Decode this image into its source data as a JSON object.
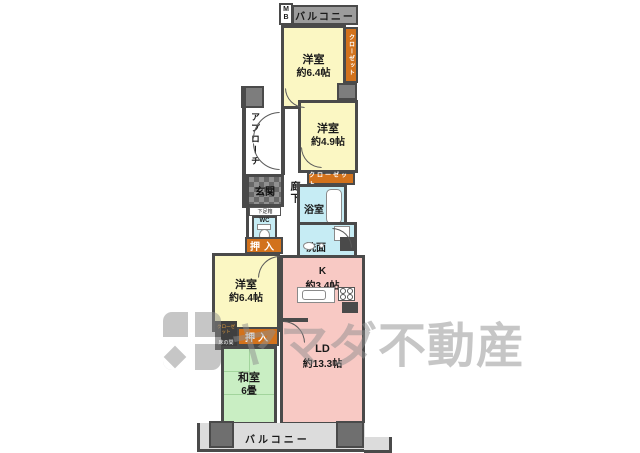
{
  "colors": {
    "wall": "#4a4a4a",
    "room_yellow": "#fbf7c3",
    "room_pink": "#f8c9c4",
    "room_green": "#c9eec3",
    "water_cyan": "#c6ecf4",
    "closet_orange": "#d2721c",
    "balcony_gray": "#dcdcdc",
    "strip_gray": "#9c9c9c",
    "block_gray": "#7d7d7d",
    "watermark_gray": "#8f8f8f"
  },
  "floorplan": {
    "balcony_top": "バルコニー",
    "balcony_bottom": "バルコニー",
    "meter_box": "M\nB",
    "rooms": {
      "western1": {
        "name": "洋室",
        "size": "約6.4帖"
      },
      "western2": {
        "name": "洋室",
        "size": "約4.9帖"
      },
      "western3": {
        "name": "洋室",
        "size": "約6.4帖"
      },
      "japanese": {
        "name": "和室",
        "size": "6畳"
      },
      "kitchen": {
        "name": "K",
        "size": "約3.4帖"
      },
      "living_dining": {
        "name": "LD",
        "size": "約13.3帖"
      }
    },
    "labels": {
      "closet_v": "クローゼット",
      "closet_h": "クローゼット",
      "closet_s": "クローゼット",
      "tokonoma": "床の間",
      "oshiire1": "押入",
      "oshiire2": "押入",
      "bath": "浴室",
      "wash": "洗面",
      "wc": "WC",
      "genkan": "玄関",
      "shoebox": "下足箱",
      "approach": "アプローチ",
      "hallway": "廊下"
    }
  },
  "watermark": {
    "brand": "ヤマダ不動産"
  }
}
